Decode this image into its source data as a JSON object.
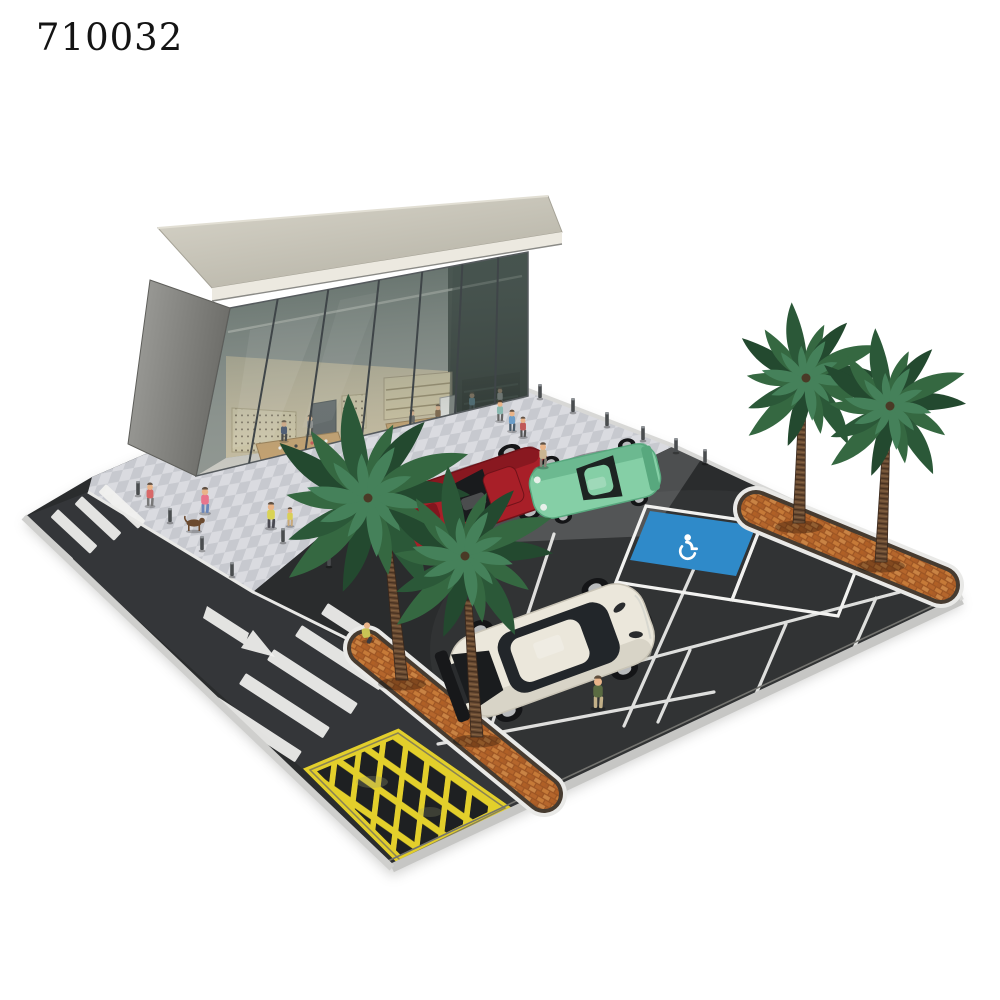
{
  "product_code": "710032",
  "scene_title": "miniature diorama - glass storefront with parking lot, palm trees and model cars",
  "colors": {
    "background": "#ffffff",
    "asphalt": "#2a2c2d",
    "road": "#343639",
    "apron": "#4d4f50",
    "plaza_a": "#dadbe0",
    "plaza_b": "#c7c9cf",
    "curb": "#c6c6c4",
    "roof": "#c9c5b8",
    "fascia": "#ece9e0",
    "glass_dark": "#3c4a45",
    "interior_wall": "#cfc2a2",
    "wood_table": "#cda268",
    "yellow_hatch": "#e3cf2b",
    "handicap_blue": "#2f8ac9",
    "brick": "#b5662c",
    "palm_dark": "#23492f",
    "palm_mid": "#356841",
    "palm_light": "#45815a",
    "trunk": "#6b4c34",
    "white_marking": "#f2f2f0"
  },
  "board": {
    "outline": "92,477 150,452 528,390 674,446 950,574 962,600 392,868 24,517",
    "plaza": "92,477 150,452 528,390 674,446 620,472 420,498 340,520 253,592 88,492",
    "apron": "400,520 420,498 620,472 674,446 702,458 650,536 470,544",
    "road": "24,517 88,492 253,592 358,648 552,800 412,868"
  },
  "markings": {
    "crosswalk_upper": {
      "angle": 43,
      "len": 54,
      "th": 11,
      "bars": [
        [
          34,
          522
        ],
        [
          58,
          509
        ],
        [
          82,
          496
        ],
        [
          106,
          484
        ]
      ]
    },
    "crosswalk_lower": {
      "angle": 33,
      "len": 100,
      "th": 13,
      "bars": [
        [
          218,
          697
        ],
        [
          246,
          673
        ],
        [
          274,
          649
        ],
        [
          302,
          625
        ],
        [
          328,
          603
        ]
      ]
    },
    "parking_lines": [
      [
        554,
        534,
        492,
        724
      ],
      [
        704,
        546,
        624,
        726
      ],
      [
        438,
        744,
        714,
        692
      ],
      [
        628,
        664,
        900,
        592
      ],
      [
        690,
        650,
        658,
        722
      ],
      [
        786,
        624,
        756,
        694
      ],
      [
        876,
        598,
        854,
        648
      ]
    ],
    "stalls": [
      "646,506 762,523 732,600 616,582",
      "762,523 868,539 838,616 732,600"
    ],
    "handicap": {
      "blue": "650,511 756,526 736,576 630,560",
      "glyph_x": 687,
      "glyph_y": 547
    },
    "arrow": {
      "shaft": "203,618 207,606 249,633 245,645",
      "head": "275,657 241,648 253,630"
    },
    "hatch_zone": "310,770 398,733 505,808 400,860"
  },
  "planters": [
    {
      "x1": 366,
      "y1": 648,
      "x2": 544,
      "y2": 794,
      "name": "planter-center"
    },
    {
      "x1": 756,
      "y1": 509,
      "x2": 941,
      "y2": 585,
      "name": "planter-right"
    }
  ],
  "palms": [
    {
      "cx": 368,
      "cy": 498,
      "r": 102,
      "trunk": [
        388,
        545,
        402,
        680
      ]
    },
    {
      "cx": 465,
      "cy": 556,
      "r": 88,
      "trunk": [
        468,
        600,
        477,
        737
      ]
    },
    {
      "cx": 806,
      "cy": 378,
      "r": 74,
      "trunk": [
        802,
        415,
        799,
        523
      ]
    },
    {
      "cx": 890,
      "cy": 406,
      "r": 76,
      "trunk": [
        886,
        448,
        881,
        562
      ]
    }
  ],
  "bollards": [
    [
      138,
      495
    ],
    [
      170,
      522
    ],
    [
      202,
      550
    ],
    [
      232,
      576
    ],
    [
      283,
      542
    ],
    [
      329,
      566
    ],
    [
      540,
      398
    ],
    [
      573,
      412
    ],
    [
      607,
      426
    ],
    [
      643,
      440
    ],
    [
      676,
      452
    ],
    [
      705,
      463
    ]
  ],
  "cars": [
    {
      "name": "car-red-coupe",
      "type": "coupe",
      "cx": 471,
      "cy": 499,
      "angle": 161,
      "length": 172,
      "width": 62,
      "body": "#a81f28",
      "trim": "#701219",
      "glass": "#191b1d"
    },
    {
      "name": "car-green-porsche",
      "type": "porsche",
      "cx": 595,
      "cy": 481,
      "angle": 167,
      "length": 130,
      "width": 54,
      "body": "#85cfa6",
      "trim": "#58a87e",
      "glass": "#1d2422"
    },
    {
      "name": "car-white-gtr",
      "type": "gtr",
      "cx": 552,
      "cy": 650,
      "angle": -20,
      "length": 205,
      "width": 84,
      "body": "#ebe7db",
      "trim": "#c9c4b6",
      "glass": "#22262a"
    }
  ],
  "figures_outside": [
    {
      "x": 205,
      "y": 513,
      "s": 1,
      "shirt": "#e8748c",
      "pants": "#6b86b8",
      "name": "figure-dog-walker"
    },
    {
      "x": 271,
      "y": 528,
      "s": 1,
      "shirt": "#d9d355",
      "pants": "#4a4a52",
      "name": "figure-yellow-shirt"
    },
    {
      "x": 290,
      "y": 526,
      "s": 0.72,
      "shirt": "#d9cf55",
      "pants": "#c8a87a",
      "name": "figure-child"
    },
    {
      "x": 543,
      "y": 467,
      "s": 0.95,
      "shirt": "#c9b592",
      "pants": "#8a8178",
      "name": "figure-walking-woman"
    },
    {
      "x": 512,
      "y": 431,
      "s": 0.82,
      "shirt": "#6a9cc8",
      "pants": "#4a5a68",
      "name": "figure-shopper"
    },
    {
      "x": 523,
      "y": 437,
      "s": 0.78,
      "shirt": "#c05858",
      "pants": "#555555",
      "name": "figure-shopper"
    },
    {
      "x": 500,
      "y": 421,
      "s": 0.8,
      "shirt": "#88b8b0",
      "pants": "#666666",
      "name": "figure-shopper"
    },
    {
      "x": 150,
      "y": 506,
      "s": 0.9,
      "shirt": "#d86868",
      "pants": "#777777",
      "name": "figure-pedestrian"
    },
    {
      "x": 598,
      "y": 708,
      "s": 1.25,
      "shirt": "#5a6b42",
      "pants": "#c2b088",
      "name": "figure-man-by-car"
    }
  ],
  "figure_sitting": {
    "x": 368,
    "y": 641,
    "s": 1,
    "shirt": "#c9c455",
    "pants": "#3a3a40",
    "name": "figure-sitting-on-planter"
  },
  "dog": {
    "x": 194,
    "y": 531,
    "color": "#6b4a2f",
    "name": "dog"
  },
  "figures_inside": [
    {
      "x": 284,
      "y": 441,
      "s": 0.8,
      "shirt": "#3a4a6b",
      "pants": "#333333"
    },
    {
      "x": 310,
      "y": 435,
      "s": 0.78,
      "shirt": "#8a8a8a",
      "pants": "#444444"
    },
    {
      "x": 352,
      "y": 431,
      "s": 0.78,
      "shirt": "#7a7a4a",
      "pants": "#555555"
    },
    {
      "x": 412,
      "y": 429,
      "s": 0.75,
      "shirt": "#5a5a5a",
      "pants": "#333333"
    },
    {
      "x": 438,
      "y": 423,
      "s": 0.72,
      "shirt": "#7a5a3a",
      "pants": "#444444"
    },
    {
      "x": 472,
      "y": 412,
      "s": 0.78,
      "shirt": "#6aa8c8",
      "pants": "#3a4a52"
    },
    {
      "x": 500,
      "y": 406,
      "s": 0.72,
      "shirt": "#c8c8c8",
      "pants": "#555555"
    }
  ]
}
